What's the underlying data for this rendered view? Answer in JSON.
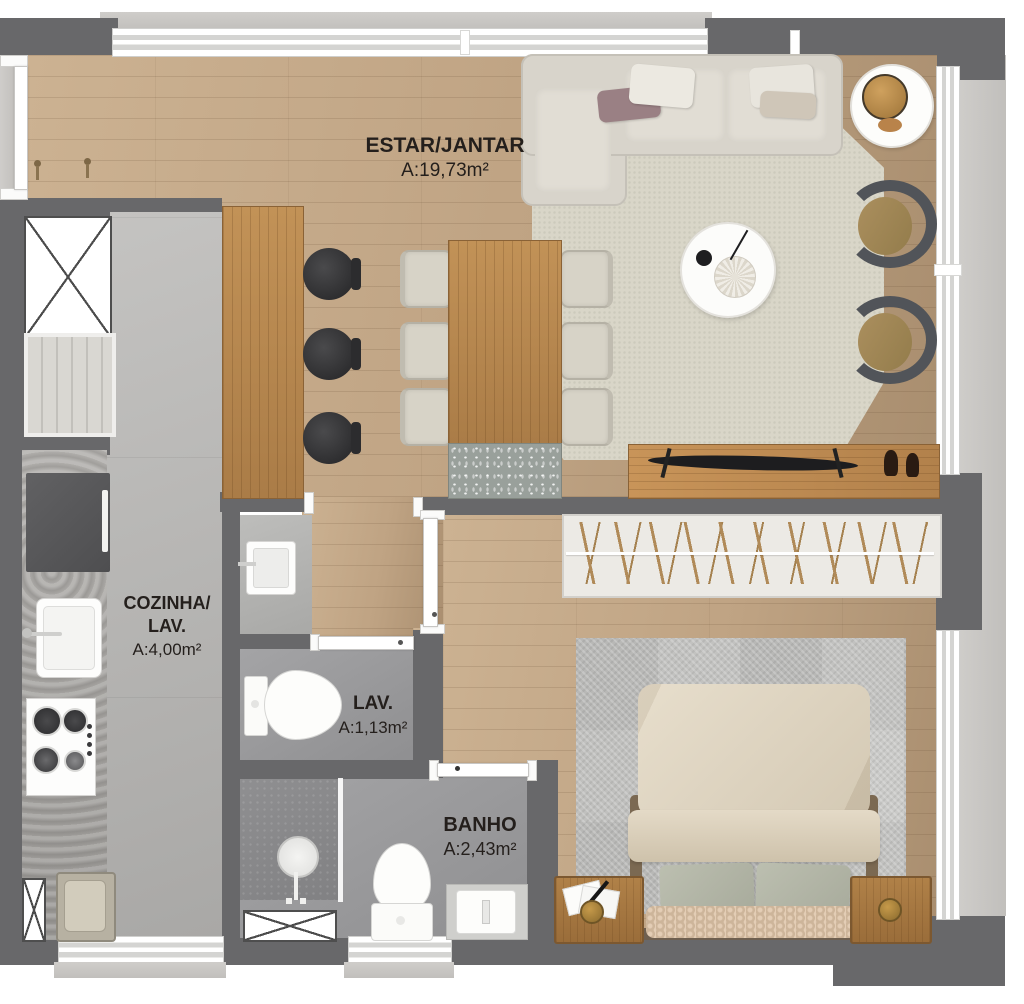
{
  "rooms": {
    "estar_jantar": {
      "name": "ESTAR/JANTAR",
      "area": "A:19,73m²"
    },
    "cozinha_lav": {
      "line1": "COZINHA/",
      "line2": "LAV.",
      "area": "A:4,00m²"
    },
    "lav": {
      "name": "LAV.",
      "area": "A:1,13m²"
    },
    "banho": {
      "name": "BANHO",
      "area": "A:2,43m²"
    }
  },
  "colors": {
    "wall": "#68686a",
    "wood_floor": "#bfa383",
    "kitchen_floor": "#b5b4b2",
    "wet_floor": "#97979a",
    "granite_counter": "#a6a4a1",
    "island_wood": "#b98d59",
    "rug_living": "#d9d6c8",
    "rug_bedroom": "#cacac8",
    "sofa": "#d8d4cb",
    "armchair_cushion": "#a18757",
    "bed_duvet": "#ded5c3",
    "pillow_sage": "#b2b5a6",
    "accent_brass": "#a87f3c",
    "exterior_ledge": "#c9c7c3",
    "label_text": "#241f1c"
  }
}
